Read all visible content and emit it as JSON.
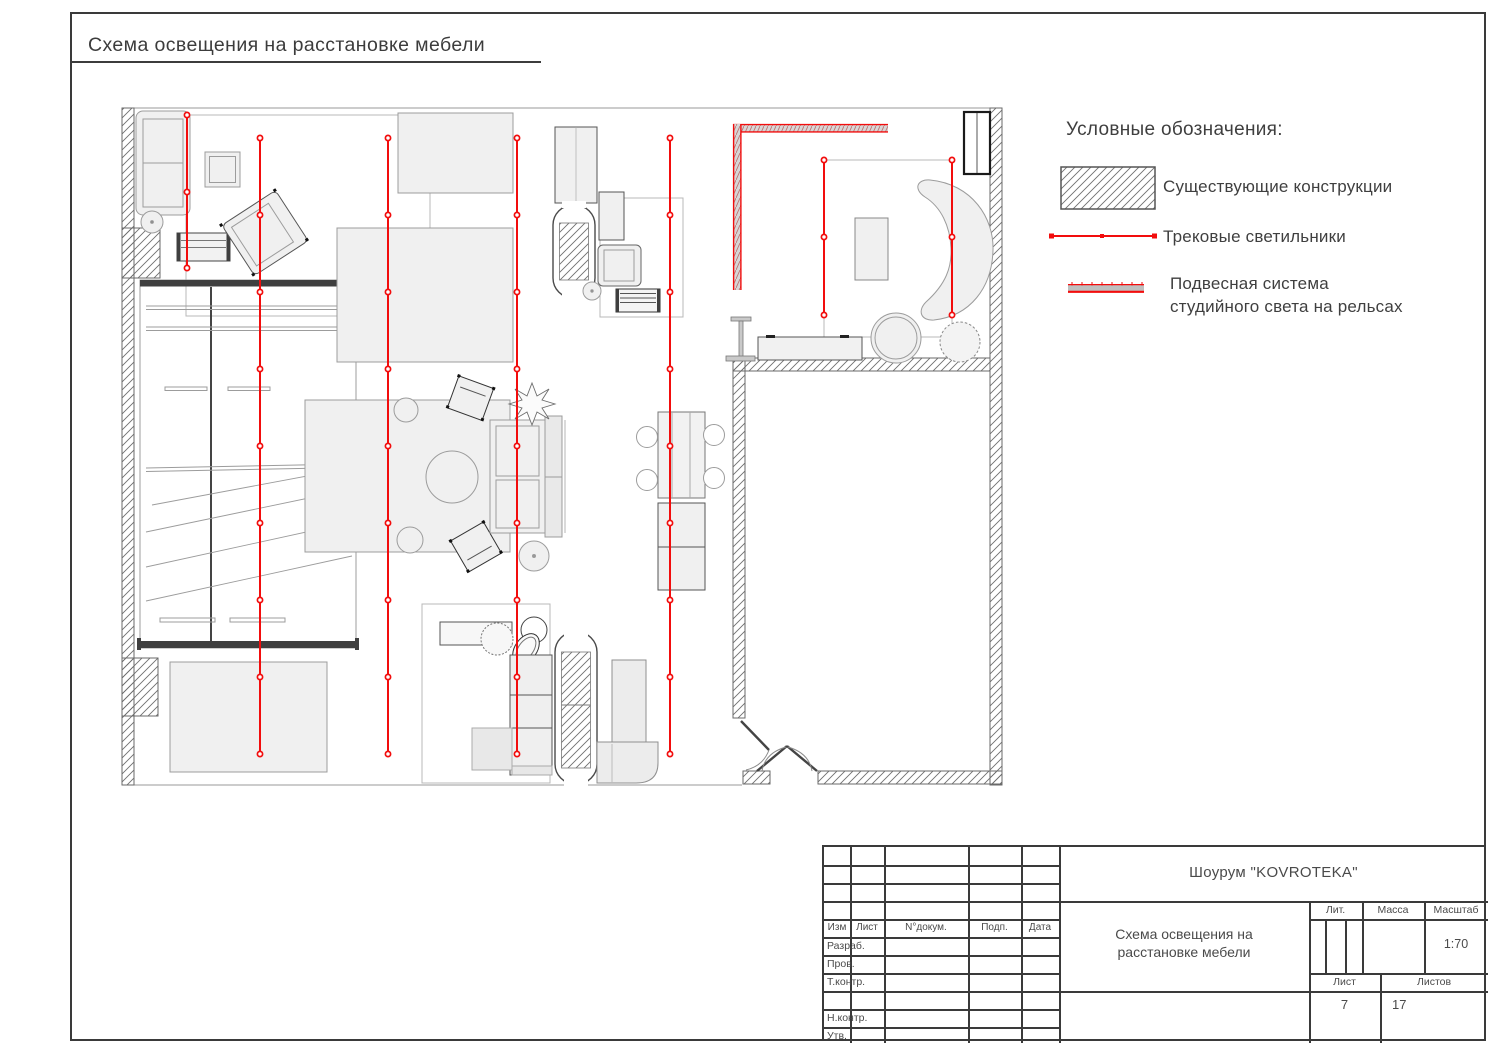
{
  "page": {
    "title": "Схема освещения на расстановке мебели"
  },
  "legend": {
    "title": "Условные обозначения:",
    "items": [
      {
        "symbol": "hatched-rect",
        "label": "Существующие конструкции"
      },
      {
        "symbol": "red-track-line",
        "label": "Трековые светильники"
      },
      {
        "symbol": "red-rail-bar",
        "label": "Подвесная система студийного света на рельсах",
        "label_line1": "Подвесная система",
        "label_line2": "студийного света на рельсах"
      }
    ]
  },
  "title_block": {
    "company": "Шоурум \"KOVROTEKA\"",
    "document_title_line1": "Схема освещения на",
    "document_title_line2": "расстановке мебели",
    "columns": {
      "izm": "Изм",
      "list": "Лист",
      "doc": "N°докум.",
      "podp": "Подп.",
      "data": "Дата"
    },
    "rows": {
      "razrab": "Разраб.",
      "prov": "Пров.",
      "tkontr": "Т.контр.",
      "nkontr": "Н.контр.",
      "utv": "Утв."
    },
    "lit_label": "Лит.",
    "massa_label": "Масса",
    "masshtab_label": "Масштаб",
    "scale_value": "1:70",
    "list_label": "Лист",
    "listov_label": "Листов",
    "sheet_number": "7",
    "sheets_total": "17"
  },
  "colors": {
    "track_red": "#f20d0d",
    "line_dark": "#3a3a3a",
    "furniture_fill": "#f0f0f0",
    "furniture_stroke": "#9c9c9c"
  },
  "plan": {
    "track_color": "#f20d0d",
    "tracks": [
      {
        "x": 187,
        "y1": 115,
        "y2": 268,
        "dots": [
          115,
          192,
          268
        ]
      },
      {
        "x": 260,
        "y1": 138,
        "y2": 754,
        "dots": [
          138,
          215,
          292,
          369,
          446,
          523,
          600,
          677,
          754
        ]
      },
      {
        "x": 388,
        "y1": 138,
        "y2": 754,
        "dots": [
          138,
          215,
          292,
          369,
          446,
          523,
          600,
          677,
          754
        ]
      },
      {
        "x": 517,
        "y1": 138,
        "y2": 754,
        "dots": [
          138,
          215,
          292,
          369,
          446,
          523,
          600,
          677,
          754
        ]
      },
      {
        "x": 670,
        "y1": 138,
        "y2": 754,
        "dots": [
          138,
          215,
          292,
          369,
          446,
          523,
          600,
          677,
          754
        ]
      },
      {
        "x": 824,
        "y1": 160,
        "y2": 315,
        "dots": [
          160,
          237,
          315
        ]
      },
      {
        "x": 952,
        "y1": 160,
        "y2": 315,
        "dots": [
          160,
          237,
          315
        ]
      }
    ]
  }
}
